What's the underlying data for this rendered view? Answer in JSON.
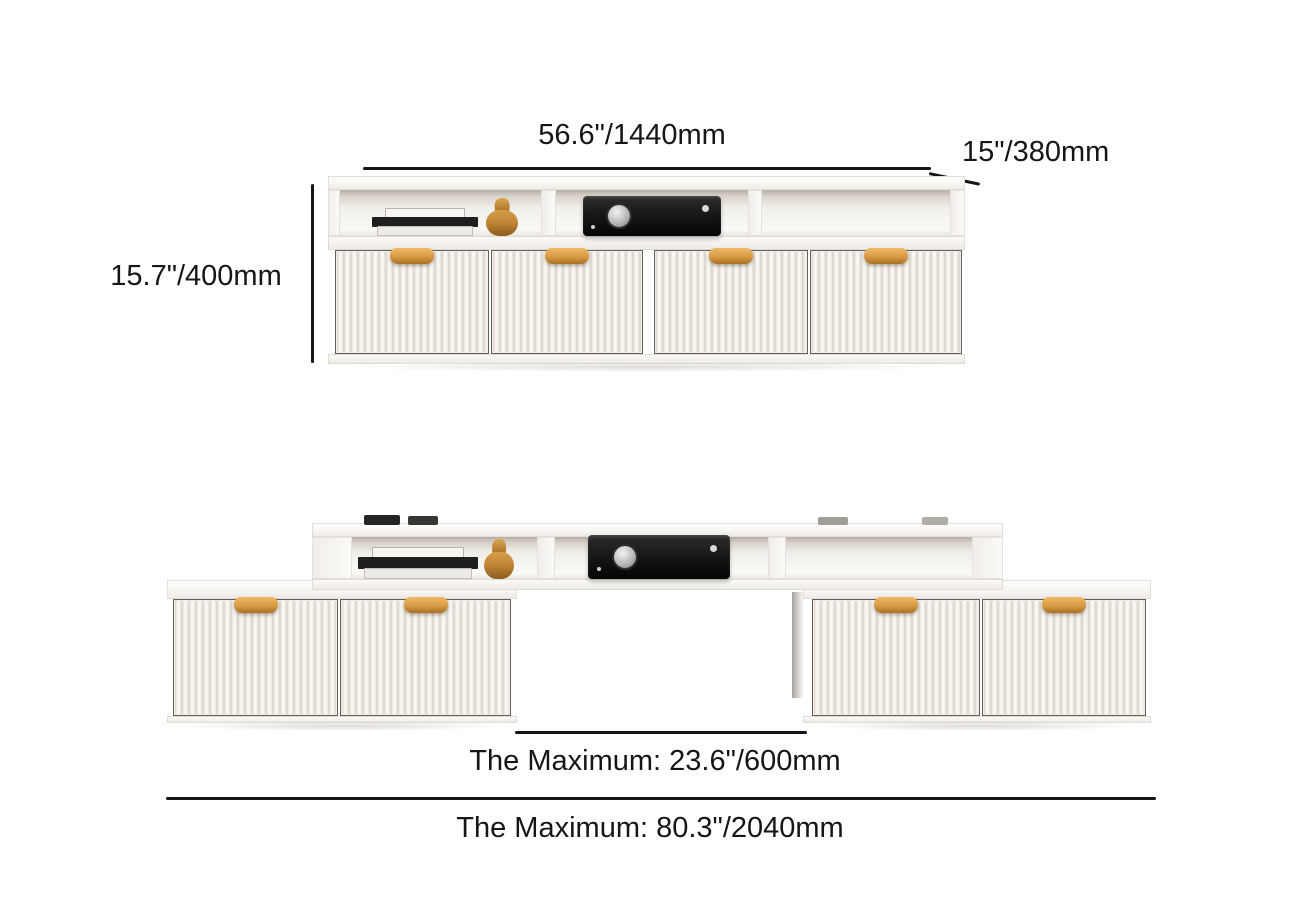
{
  "page": {
    "background": "#ffffff",
    "text_color": "#161616",
    "line_color": "#151515"
  },
  "colors": {
    "cabinet_white": "#f6f4f1",
    "flute_shadow": "#d7d1c7",
    "handle_gold": "#d89a44",
    "receiver_black": "#141413",
    "figurine_amber": "#c08435"
  },
  "views": {
    "collapsed": {
      "title": "tv-stand-collapsed-view",
      "width_label": "56.6\"/1440mm",
      "depth_label": "15\"/380mm",
      "height_label": "15.7\"/400mm"
    },
    "extended": {
      "title": "tv-stand-extended-view",
      "gap_label": "The Maximum: 23.6\"/600mm",
      "total_width_label": "The Maximum: 80.3\"/2040mm"
    }
  },
  "decor": {
    "shelf_items": [
      "books-stack",
      "decor-vase",
      "media-player"
    ],
    "top_items": [
      "remote-control",
      "remote-control",
      "flat-box",
      "flat-box"
    ]
  }
}
